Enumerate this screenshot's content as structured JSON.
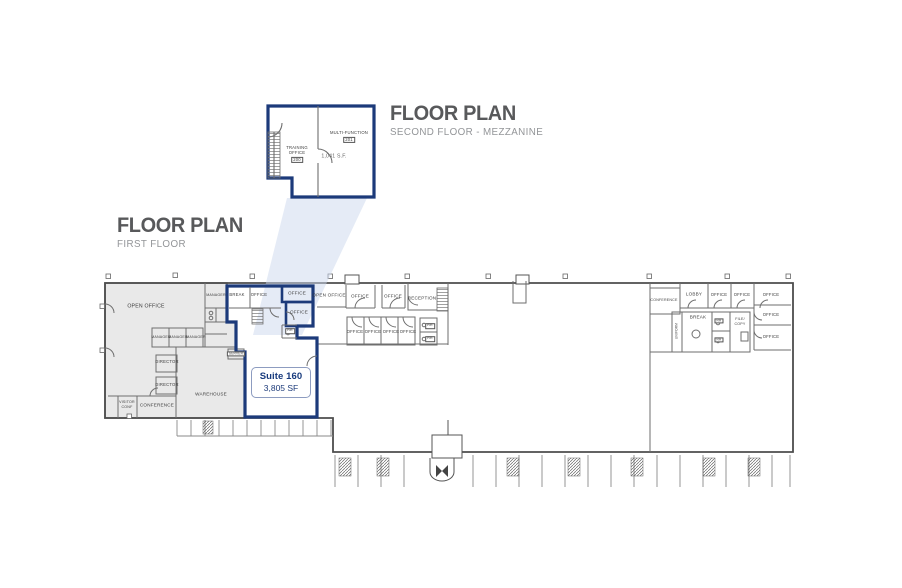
{
  "titles": {
    "first": {
      "heading": "FLOOR PLAN",
      "subheading": "FIRST FLOOR"
    },
    "second": {
      "heading": "FLOOR PLAN",
      "subheading": "SECOND FLOOR - MEZZANINE"
    }
  },
  "suite_label": {
    "name": "Suite 160",
    "area": "3,805 SF"
  },
  "mezzanine": {
    "training_room": {
      "line1": "TRAINING",
      "line2": "OFFICE",
      "number": "200"
    },
    "multifunction_room": {
      "name": "MULTI-FUNCTION",
      "number": "201"
    },
    "area": "1,041 S.F."
  },
  "rooms": {
    "grey": {
      "open_office": "OPEN OFFICE",
      "manager1": "MANAGER",
      "manager2": "MANAGER",
      "manager3": "MANAGER",
      "manager4": "MANAGER",
      "director1": "DIRECTOR",
      "director2": "DIRECTOR",
      "visitor_conf_line1": "VISITOR",
      "visitor_conf_line2": "CONF",
      "conference": "CONFERENCE",
      "warehouse": "WAREHOUSE",
      "server": "SERVER"
    },
    "suite": {
      "break": "BREAK",
      "office1": "OFFICE",
      "office2": "OFFICE",
      "office3": "OFFICE",
      "rr": "RR"
    },
    "middle": {
      "open_office": "OPEN OFFICE",
      "office1": "OFFICE",
      "office2": "OFFICE",
      "reception": "RECEPTION",
      "office3": "OFFICE",
      "office4": "OFFICE",
      "office5": "OFFICE",
      "office6": "OFFICE",
      "rr1": "RR",
      "rr2": "RR"
    },
    "right": {
      "conference": "CONFERENCE",
      "lobby": "LOBBY",
      "office1": "OFFICE",
      "office2": "OFFICE",
      "office3": "OFFICE",
      "office4": "OFFICE",
      "office5": "OFFICE",
      "uniform": "UNIFORM",
      "break": "BREAK",
      "rr1": "RR",
      "rr2": "RR",
      "filecopy_line1": "FILE/",
      "filecopy_line2": "COPY"
    }
  },
  "colors": {
    "suite_outline_navy": "#1c3a7a",
    "wall_gray": "#666666",
    "existing_space_fill": "#e9e9e9",
    "projection_beam": "#ccd7ee",
    "title_gray": "#58595b",
    "subtitle_gray": "#939598"
  }
}
